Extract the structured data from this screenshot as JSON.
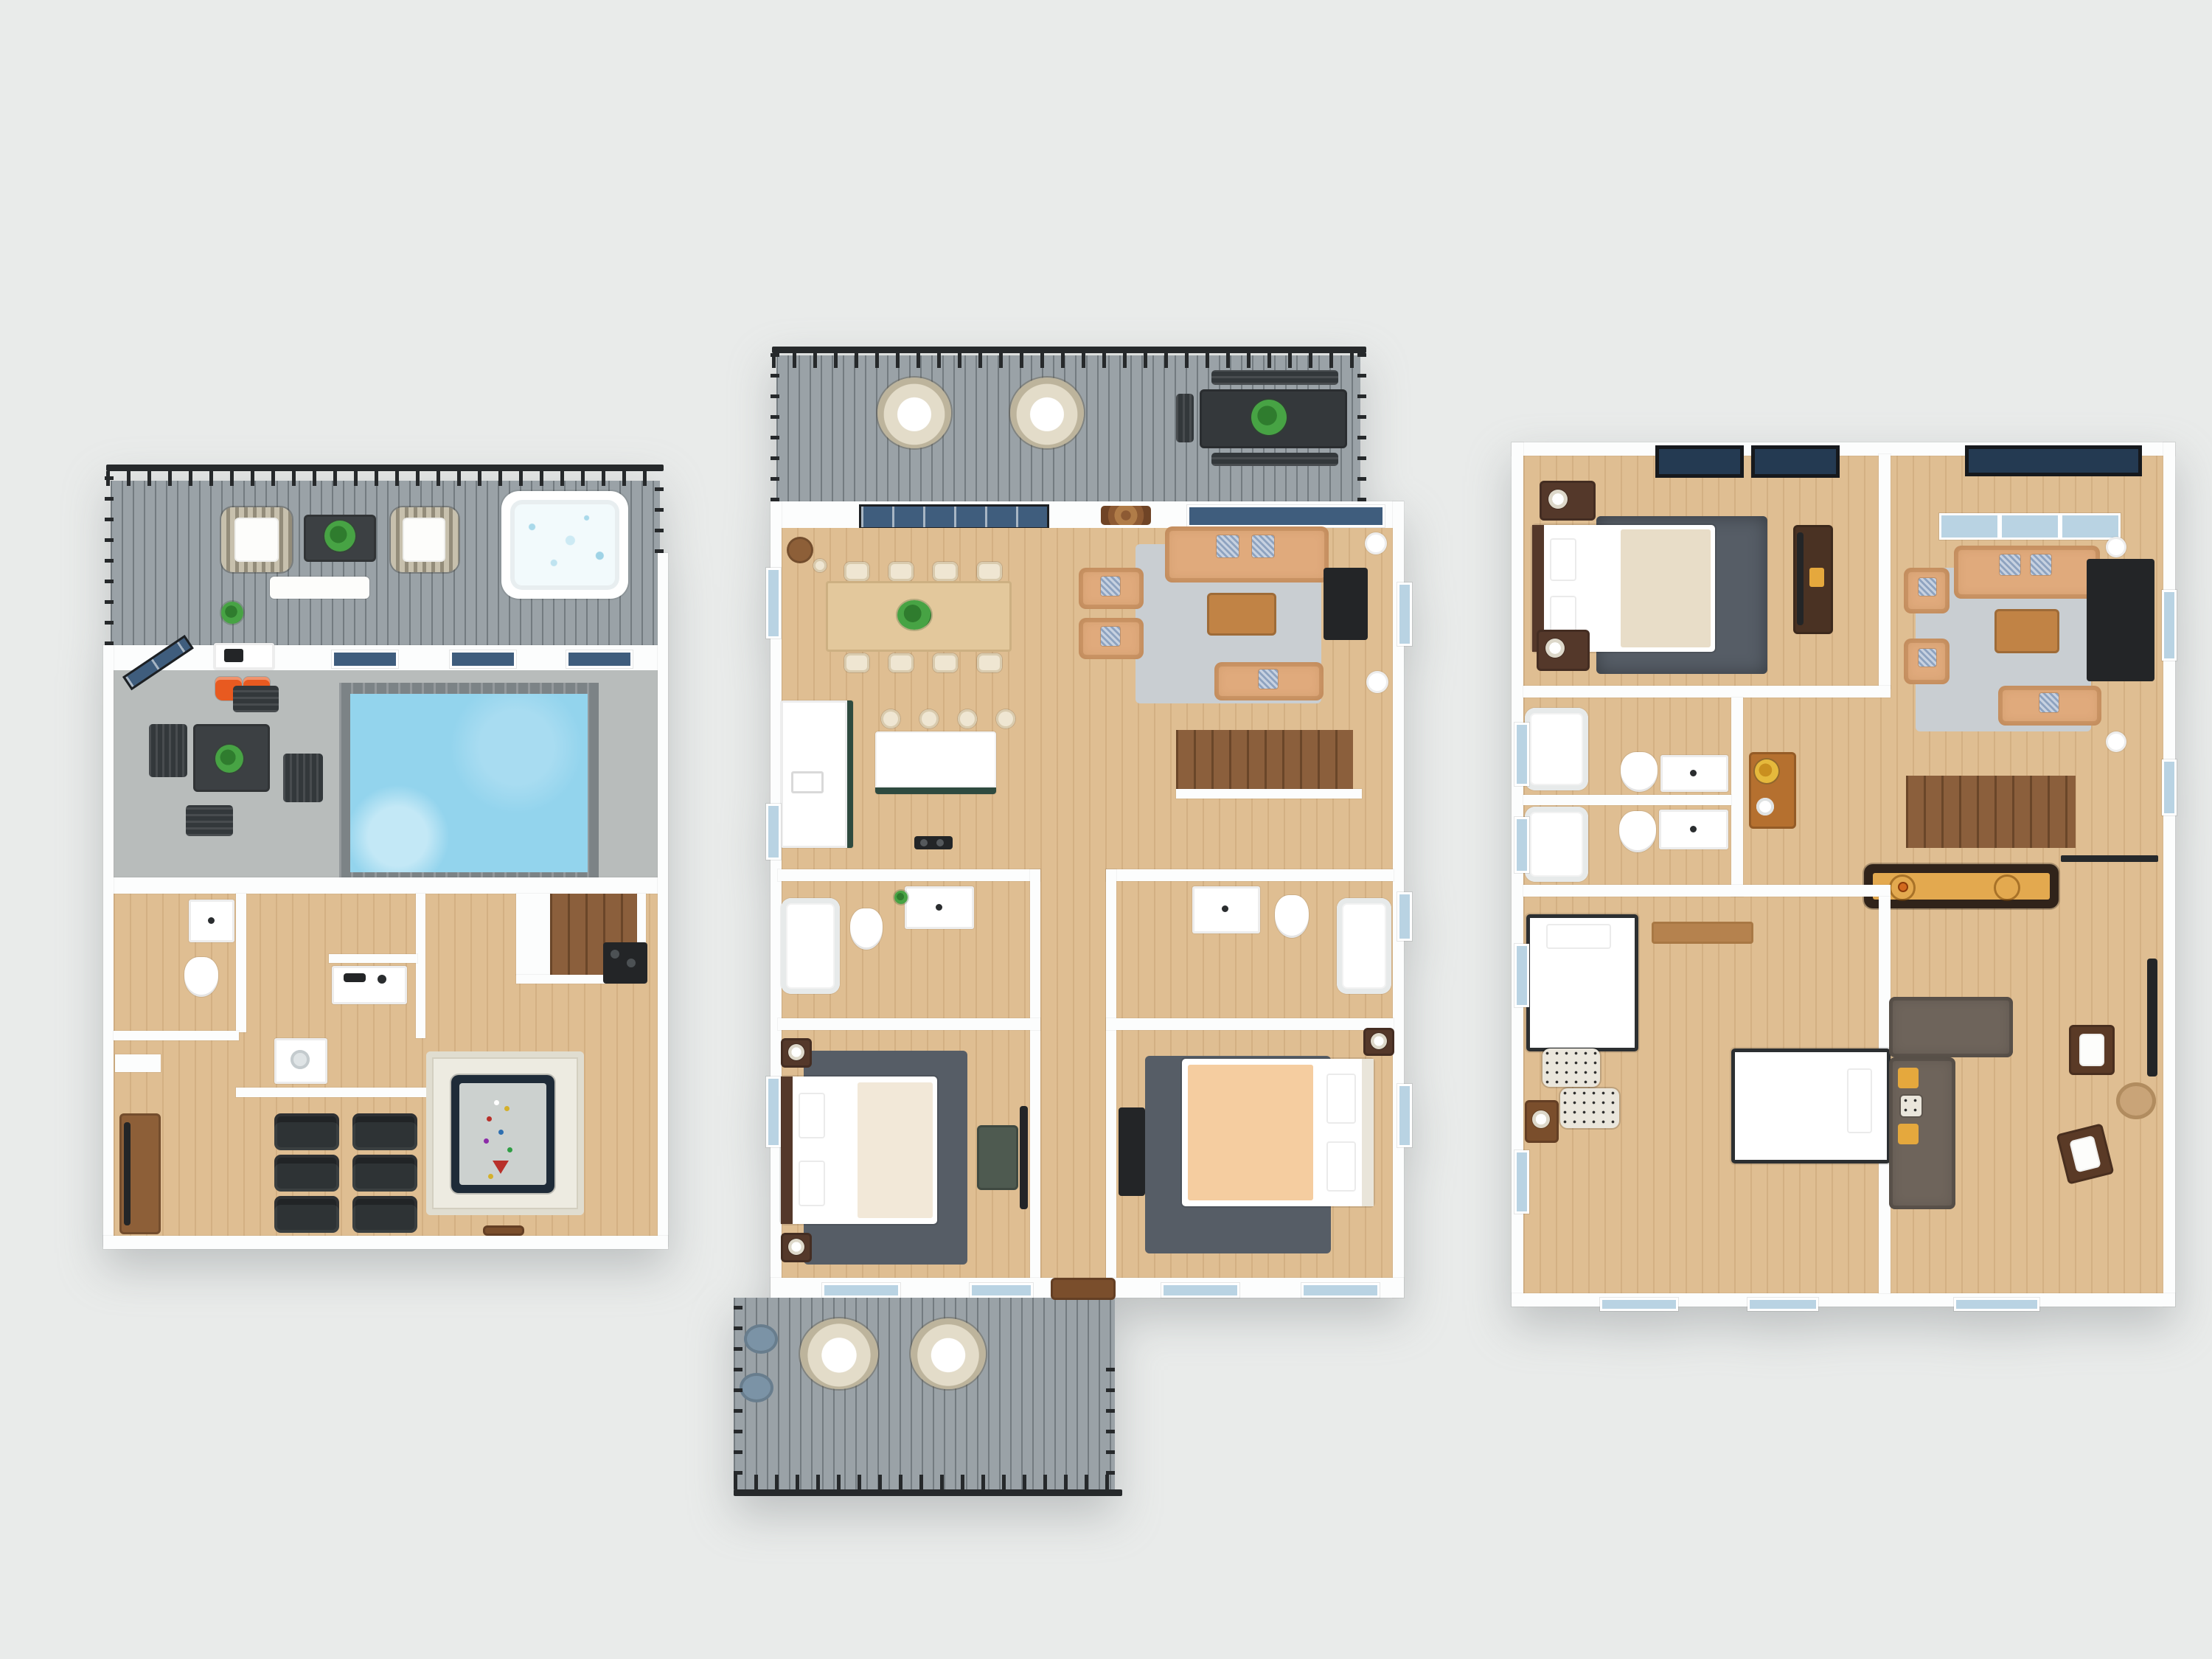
{
  "scene": {
    "type": "3d-floor-plan-rendering",
    "view": "top-down dollhouse render",
    "floor_count": 3,
    "visible_text": [],
    "background_color": "#e9ebea"
  },
  "palette": {
    "bg": "#e9ebea",
    "wall": "#fcfdfd",
    "wood": "#dfbe92",
    "wood_line": "rgba(150,102,52,.16)",
    "deck": "#9aa2a7",
    "rail": "#26292b",
    "concrete": "#b8bcbb",
    "pool_water": "#93d4ed",
    "pool_tile": "#7c8386",
    "glass_dark": "#3f5d7d",
    "glass_light": "#b9d3e3",
    "skylight": "#243a52",
    "sofa_tan": "#e0aa7c",
    "rug_light": "#c9ced2",
    "rug_dark": "#565d66",
    "rug_white": "#edebe1",
    "stairs_wood": "#8b5f3c",
    "dark_wood": "#54382a",
    "mid_wood": "#8d5f38",
    "black": "#232527",
    "island_green": "#2e4a3f",
    "cream": "#f2e8d8",
    "peach": "#f5cda0",
    "orange": "#e85a20",
    "felt": "#ccd1cf",
    "shuffle_lane": "#e3a94f",
    "sectional": "#6e645b",
    "yellow": "#e5a83d",
    "plant": "#3f8f3c",
    "steel_blue": "#7b93a6"
  },
  "floors": [
    {
      "name": "lower-level",
      "position": "left",
      "zones": [
        "roof-deck",
        "hot-tub-corner",
        "indoor-pool-patio",
        "bathroom",
        "office-nook",
        "laundry-closet",
        "staircase",
        "media-room",
        "billiards-area"
      ],
      "furniture": [
        {
          "name": "wicker-lounge-chair",
          "count": 2
        },
        {
          "name": "deck-coffee-table",
          "count": 1
        },
        {
          "name": "outdoor-bench",
          "count": 1
        },
        {
          "name": "potted-plant",
          "count": 3
        },
        {
          "name": "hot-tub",
          "count": 1
        },
        {
          "name": "swimming-pool",
          "count": 1
        },
        {
          "name": "patio-dining-table",
          "count": 1
        },
        {
          "name": "adirondack-chair",
          "count": 4
        },
        {
          "name": "orange-butterfly-chair",
          "count": 2
        },
        {
          "name": "grill-counter",
          "count": 1
        },
        {
          "name": "bathroom-vanity",
          "count": 1
        },
        {
          "name": "toilet",
          "count": 1
        },
        {
          "name": "desk",
          "count": 1
        },
        {
          "name": "washer",
          "count": 1
        },
        {
          "name": "staircase",
          "count": 1
        },
        {
          "name": "beverage-station",
          "count": 1
        },
        {
          "name": "pool-table",
          "count": 1
        },
        {
          "name": "white-area-rug",
          "count": 1
        },
        {
          "name": "theater-recliner",
          "count": 6
        },
        {
          "name": "media-console",
          "count": 1
        }
      ]
    },
    {
      "name": "main-level",
      "position": "center",
      "zones": [
        "upper-deck",
        "dining-area",
        "kitchen",
        "living-room",
        "hallway",
        "bathroom-left",
        "bathroom-right",
        "bedroom-left",
        "bedroom-right",
        "lower-deck",
        "staircase"
      ],
      "furniture": [
        {
          "name": "hanging-egg-chair",
          "count": 4
        },
        {
          "name": "outdoor-dining-table",
          "count": 1
        },
        {
          "name": "outdoor-bench",
          "count": 2
        },
        {
          "name": "fireplace-console",
          "count": 1
        },
        {
          "name": "dining-table",
          "count": 1
        },
        {
          "name": "dining-chair",
          "count": 8
        },
        {
          "name": "bar-table",
          "count": 1
        },
        {
          "name": "kitchen-counter",
          "count": 1
        },
        {
          "name": "kitchen-island",
          "count": 1
        },
        {
          "name": "bar-stool",
          "count": 4
        },
        {
          "name": "range-cooktop",
          "count": 1
        },
        {
          "name": "sofa",
          "count": 1
        },
        {
          "name": "armchair",
          "count": 2
        },
        {
          "name": "loveseat",
          "count": 1
        },
        {
          "name": "coffee-table",
          "count": 1
        },
        {
          "name": "tv-console",
          "count": 3
        },
        {
          "name": "side-table",
          "count": 2
        },
        {
          "name": "staircase",
          "count": 1
        },
        {
          "name": "bathtub",
          "count": 2
        },
        {
          "name": "toilet",
          "count": 2
        },
        {
          "name": "bathroom-vanity",
          "count": 2
        },
        {
          "name": "bed",
          "count": 2
        },
        {
          "name": "nightstand",
          "count": 3
        },
        {
          "name": "bedroom-rug",
          "count": 2
        },
        {
          "name": "dresser",
          "count": 1
        },
        {
          "name": "pouf",
          "count": 2
        },
        {
          "name": "doormat",
          "count": 1
        }
      ]
    },
    {
      "name": "upper-level",
      "position": "right",
      "zones": [
        "primary-bedroom",
        "living-room",
        "bathroom-upper",
        "bathroom-lower",
        "hallway",
        "kids-bedroom",
        "family-lounge",
        "staircase"
      ],
      "furniture": [
        {
          "name": "bed",
          "count": 1
        },
        {
          "name": "shag-rug",
          "count": 1
        },
        {
          "name": "dresser",
          "count": 2
        },
        {
          "name": "nightstand",
          "count": 2
        },
        {
          "name": "media-dresser",
          "count": 1
        },
        {
          "name": "sofa",
          "count": 1
        },
        {
          "name": "armchair",
          "count": 2
        },
        {
          "name": "loveseat",
          "count": 1
        },
        {
          "name": "coffee-table",
          "count": 1
        },
        {
          "name": "entertainment-center",
          "count": 1
        },
        {
          "name": "side-table",
          "count": 2
        },
        {
          "name": "staircase",
          "count": 1
        },
        {
          "name": "shuffleboard-table",
          "count": 1
        },
        {
          "name": "bathtub",
          "count": 2
        },
        {
          "name": "toilet",
          "count": 2
        },
        {
          "name": "bathroom-vanity",
          "count": 2
        },
        {
          "name": "console-table-with-flowers",
          "count": 1
        },
        {
          "name": "twin-bed",
          "count": 2
        },
        {
          "name": "patterned-pouf",
          "count": 2
        },
        {
          "name": "bedside-table",
          "count": 1
        },
        {
          "name": "sectional-sofa",
          "count": 1
        },
        {
          "name": "accent-chair",
          "count": 2
        },
        {
          "name": "wall-desk",
          "count": 1
        },
        {
          "name": "round-rug",
          "count": 1
        }
      ]
    }
  ]
}
